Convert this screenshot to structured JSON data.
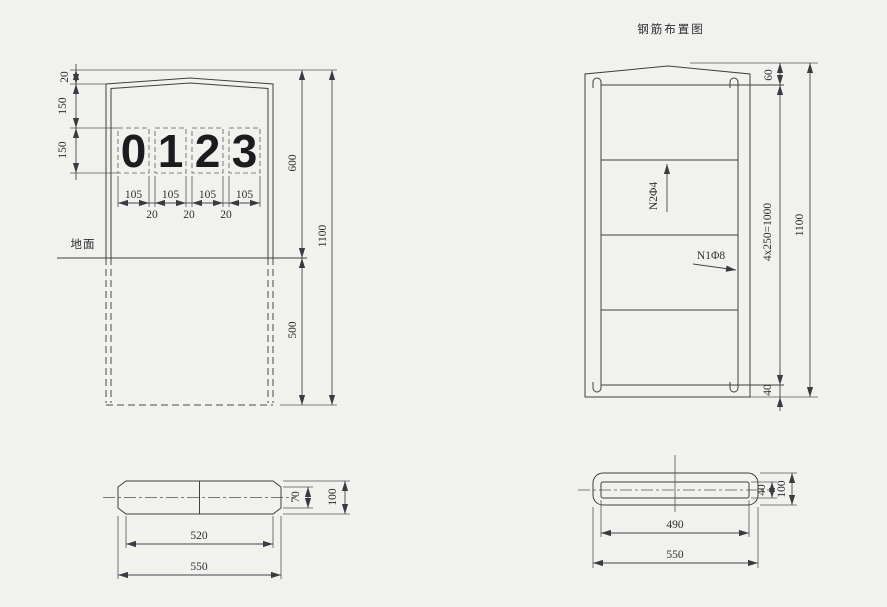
{
  "title": "钢筋布置图",
  "left_elevation": {
    "ground_label": "地面",
    "digits": [
      "0",
      "1",
      "2",
      "3"
    ],
    "dim_top_cap": "20",
    "dim_cap_to_digits": "150",
    "dim_digit_height": "150",
    "dim_digit_widths": [
      "105",
      "105",
      "105",
      "105"
    ],
    "dim_digit_gaps": [
      "20",
      "20",
      "20"
    ],
    "dim_above_ground": "600",
    "dim_below_ground": "500",
    "dim_total_height": "1100"
  },
  "left_plan": {
    "dim_inner_width": "520",
    "dim_outer_width": "550",
    "dim_inner_height": "70",
    "dim_outer_height": "100"
  },
  "rebar_elevation": {
    "label_stirrup_bar": "N2Φ4",
    "label_main_bar": "N1Φ8",
    "dim_top_cover": "60",
    "dim_bar_spacing": "4x250=1000",
    "dim_bottom_cover": "40",
    "dim_total_height": "1100"
  },
  "rebar_plan": {
    "dim_inner_width": "490",
    "dim_outer_width": "550",
    "dim_inner_height": "40",
    "dim_outer_height": "100"
  }
}
